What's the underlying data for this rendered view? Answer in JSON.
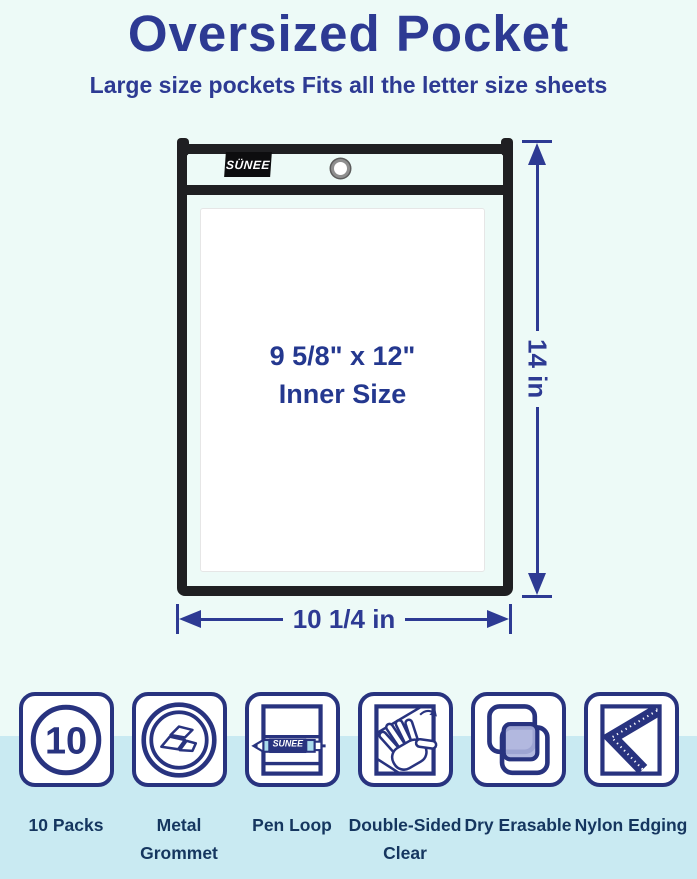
{
  "header": {
    "title": "Oversized Pocket",
    "subtitle": "Large size pockets Fits all the letter size sheets"
  },
  "pocket": {
    "brand": "SÜNEE",
    "inner_size_line1": "9 5/8\" x 12\"",
    "inner_size_line2": "Inner Size",
    "height_label": "14 in",
    "width_label": "10 1/4 in"
  },
  "features": [
    {
      "name": "10-packs",
      "label": "10 Packs",
      "badge": "10"
    },
    {
      "name": "metal-grommet",
      "label": "Metal Grommet"
    },
    {
      "name": "pen-loop",
      "label": "Pen Loop",
      "pen_text": "SUNEE"
    },
    {
      "name": "double-sided-clear",
      "label": "Double-Sided Clear"
    },
    {
      "name": "dry-erasable",
      "label": "Dry Erasable"
    },
    {
      "name": "nylon-edging",
      "label": "Nylon Edging"
    }
  ],
  "colors": {
    "accent_navy": "#2d3a93",
    "icon_navy": "#28337f",
    "label_navy": "#15365f",
    "frame_black": "#1f1f22",
    "background_top": "#edfaf7",
    "background_band": "#c9eaf2",
    "dry_erase_fill": "#aab0dc",
    "pen_light_blue": "#aadcec"
  }
}
